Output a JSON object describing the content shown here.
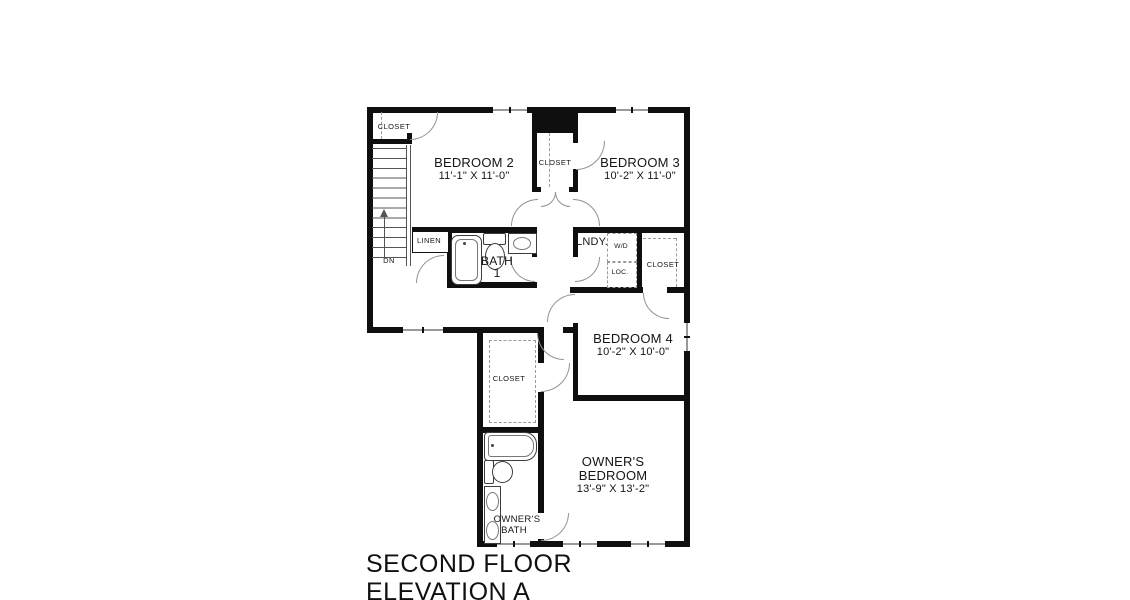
{
  "title": {
    "line1": "SECOND FLOOR",
    "line2": "ELEVATION A"
  },
  "bedroom2": {
    "name": "BEDROOM 2",
    "dims": "11'-1\" X 11'-0\""
  },
  "bedroom3": {
    "name": "BEDROOM 3",
    "dims": "10'-2\" X 11'-0\""
  },
  "bedroom4": {
    "name": "BEDROOM 4",
    "dims": "10'-2\" X 10'-0\""
  },
  "owners_bedroom": {
    "line1": "OWNER'S",
    "line2": "BEDROOM",
    "dims": "13'-9\" X 13'-2\""
  },
  "bath1": {
    "line1": "BATH",
    "line2": "1"
  },
  "owners_bath": {
    "line1": "OWNER'S",
    "line2": "BATH"
  },
  "laundry": {
    "label": "LNDY.",
    "wd": "W/D",
    "loc": "LOC."
  },
  "linen": {
    "label": "LINEN"
  },
  "stairs": {
    "label": "DN"
  },
  "closets": {
    "bedroom2": "CLOSET",
    "hall": "CLOSET",
    "bedroom4": "CLOSET",
    "owners": "CLOSET"
  }
}
